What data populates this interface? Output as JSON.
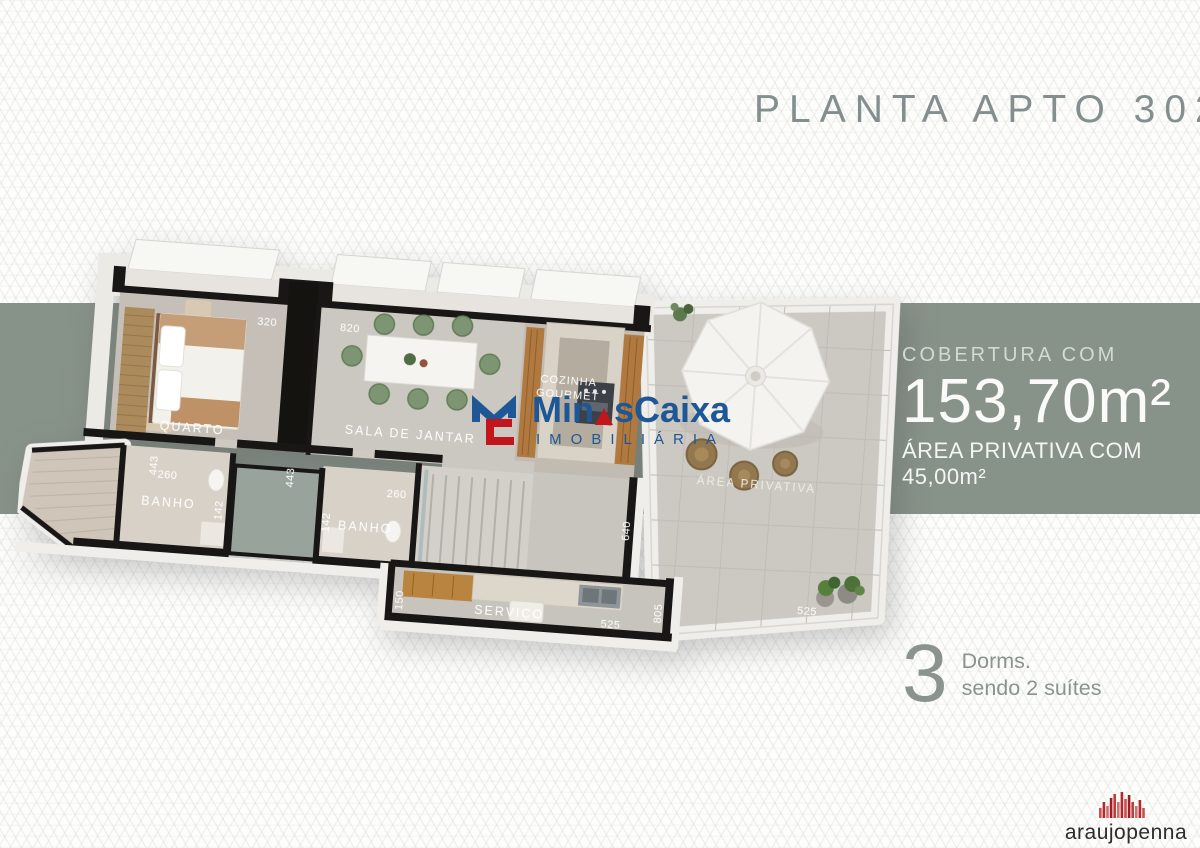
{
  "title": "PLANTA APTO 302",
  "info": {
    "line1": "COBERTURA COM",
    "area": "153,70m²",
    "line3": "ÁREA PRIVATIVA COM 45,00m²"
  },
  "dorms": {
    "count": "3",
    "label": "Dorms.",
    "sublabel": "sendo 2 suítes"
  },
  "watermark": {
    "name_pre": "Min",
    "name_post": "sCaixa",
    "subtitle": "IMOBILIÁRIA"
  },
  "agency": {
    "name": "araujopenna"
  },
  "plan": {
    "rooms": {
      "quarto": "QUARTO",
      "sala": "SALA DE JANTAR",
      "cozinha_line1": "COZINHA",
      "cozinha_line2": "GOURMET",
      "banho_left": "BANHO",
      "banho_right": "BANHO",
      "servico": "SERVIÇO",
      "area_privativa": "ÁREA PRIVATIVA"
    },
    "dims": {
      "quarto_top": "320",
      "sala_top": "820",
      "quarto_bottom": "443",
      "sala_bottom": "443",
      "banho_left_w": "260",
      "banho_left_h": "142",
      "banho_right_h": "142",
      "banho_right_w": "260",
      "hall": "640",
      "servico_h": "150",
      "servico_w": "525",
      "terraco_h": "805",
      "terraco_w": "525"
    }
  },
  "colors": {
    "band": "#879289",
    "logo_blue": "#1D5796",
    "logo_red": "#C3161C"
  }
}
